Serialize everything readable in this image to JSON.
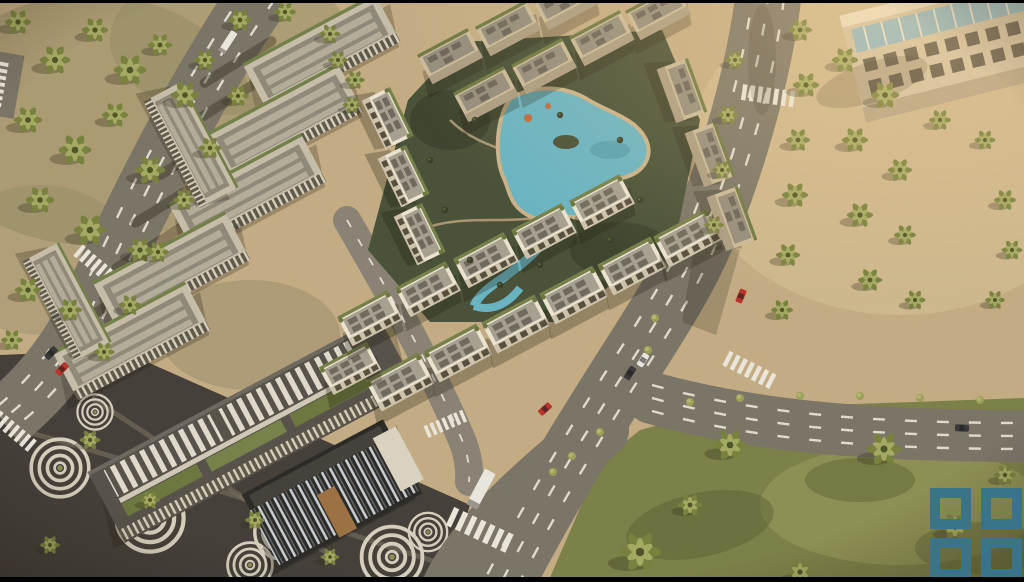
{
  "scene": {
    "kind": "Aerial 3D architectural render (video still)",
    "subject": "Master-planned residential compound: white mid-rise apartment blocks around a winding turquoise lagoon pool, office campus with louvered facades, retail plaza paved with concentric circle motifs, curving palm-lined boulevards and sunlit lawns",
    "lighting": "Warm late-afternoon sun from upper right, long shadows toward lower left",
    "regions": {
      "top_left": "Sandy park densely planted with palm trees beside a diagonal avenue",
      "upper_left": "Office campus of flat-roofed slabs with green roof strips",
      "center": "Residential blocks enclosing the lagoon pool courtyard",
      "bottom_left": "Retail strip and dark plaza with concentric-circle paving and palms",
      "bottom_center": "Road junction with zebra crossings and a white box truck",
      "right": "Wide curving boulevard with dashed lanes, palm groves and lawns",
      "top_right": "Beige apartment tower with a band of blue glass balconies"
    },
    "water": "Free-form turquoise lagoon pool with island and lazy-river channel",
    "vehicles": [
      "red cars",
      "dark cars",
      "white van",
      "white box truck"
    ]
  },
  "watermark": {
    "name": "four-squares logo",
    "description": "2x2 grid of hollow teal squares in the bottom-right corner",
    "color": "#3a7488"
  },
  "letterbox": {
    "color": "#000000",
    "top_height_px": 3,
    "bottom_height_px": 5
  },
  "colors": {
    "sand": "#c3ac84",
    "sand_light": "#d8c295",
    "sand_shade": "#8d8760",
    "road": "#7b7568",
    "road_light": "#8a8375",
    "lane_dash": "#eae6d9",
    "lawn": "#7c8049",
    "lawn_light": "#9a9c5d",
    "shrub": "#9aa058",
    "plaza": "#45413a",
    "plaza_ring": "#d5cebc",
    "courtyard": "#4a5239",
    "pool": "#6ab4c2",
    "pool_deep": "#4f98a8",
    "deck": "#c9b28a",
    "building_white": "#ebe3d0",
    "building_tan": "#c9b999",
    "roof_gray": "#a6a091",
    "roof_dark": "#6f6a5d",
    "roof_green": "#76804a",
    "office_roof": "#c6bda9",
    "retail_roof": "#57534a",
    "glass_dark": "#2c2b28",
    "tower_beige": "#d2c1a2",
    "tower_glass": "#8fb5c2",
    "car_red": "#b8342c",
    "car_dark": "#3a3a3a",
    "vehicle_white": "#e8e5dc",
    "letterbox": "#000000",
    "logo": "#3a7488"
  }
}
